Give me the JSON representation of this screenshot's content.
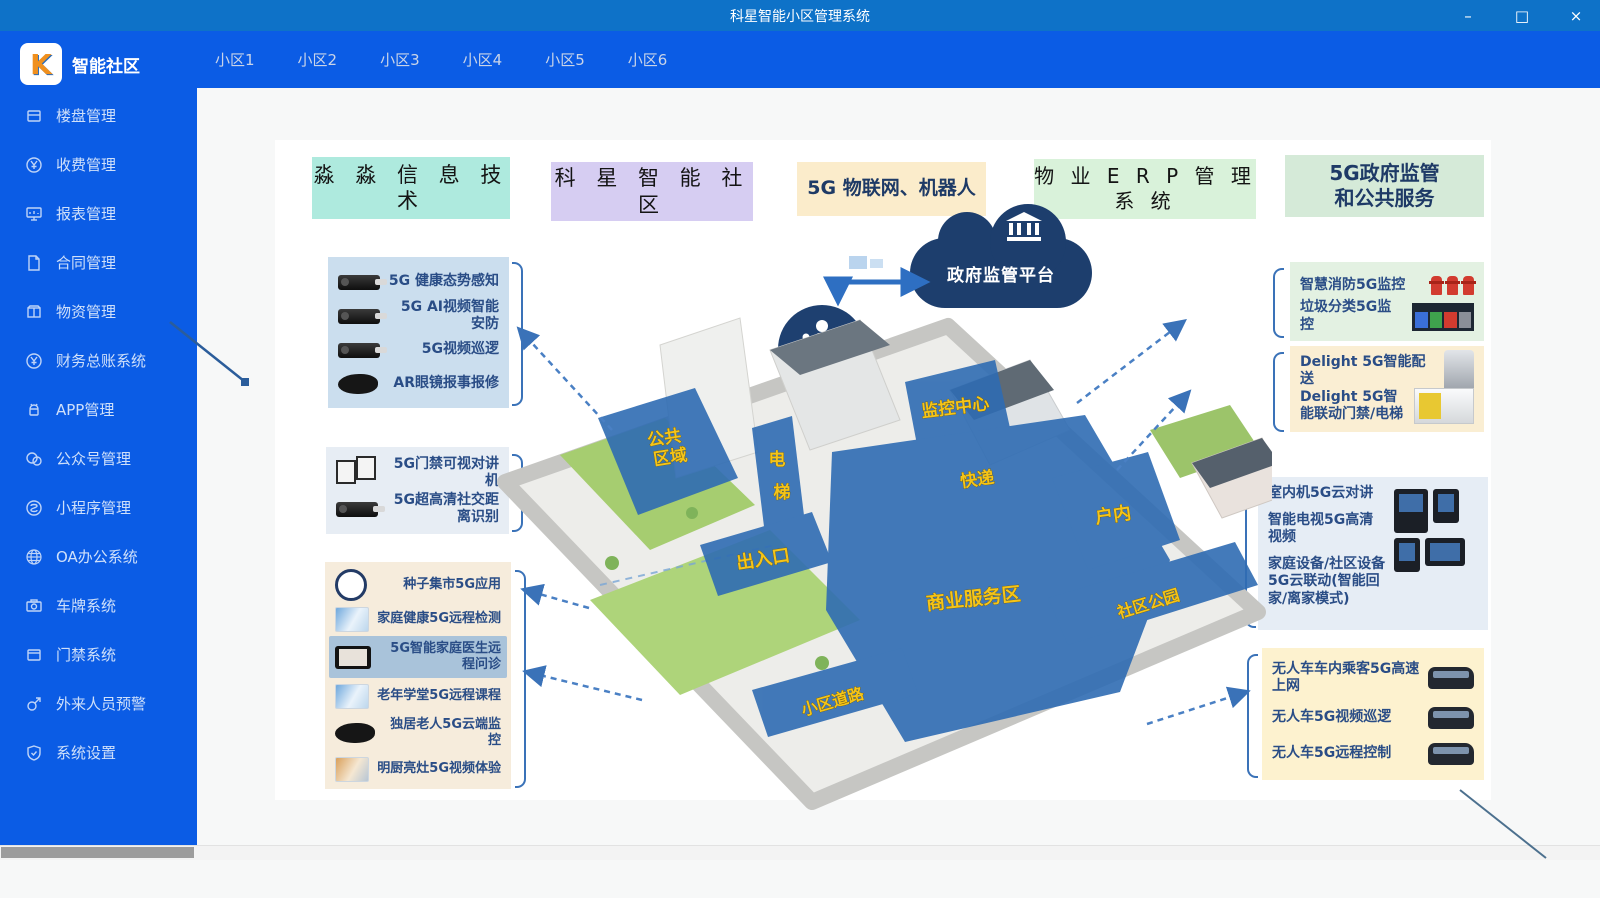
{
  "window": {
    "title": "科星智能小区管理系统",
    "controls": {
      "minimize": "–",
      "maximize": "□",
      "close": "×"
    }
  },
  "brand": {
    "logo_letter": "K",
    "name": "智能社区"
  },
  "tabs": [
    {
      "label": "小区1"
    },
    {
      "label": "小区2"
    },
    {
      "label": "小区3"
    },
    {
      "label": "小区4"
    },
    {
      "label": "小区5"
    },
    {
      "label": "小区6"
    }
  ],
  "sidebar": {
    "items": [
      {
        "icon": "building-icon",
        "label": "楼盘管理"
      },
      {
        "icon": "fee-yen-icon",
        "label": "收费管理"
      },
      {
        "icon": "report-icon",
        "label": "报表管理"
      },
      {
        "icon": "contract-icon",
        "label": "合同管理"
      },
      {
        "icon": "materials-icon",
        "label": "物资管理"
      },
      {
        "icon": "ledger-yen-icon",
        "label": "财务总账系统"
      },
      {
        "icon": "app-android-icon",
        "label": "APP管理"
      },
      {
        "icon": "wechat-icon",
        "label": "公众号管理"
      },
      {
        "icon": "miniprogram-icon",
        "label": "小程序管理"
      },
      {
        "icon": "oa-globe-icon",
        "label": "OA办公系统"
      },
      {
        "icon": "plate-camera-icon",
        "label": "车牌系统"
      },
      {
        "icon": "door-icon",
        "label": "门禁系统"
      },
      {
        "icon": "visitor-male-icon",
        "label": "外来人员预警"
      },
      {
        "icon": "settings-shield-icon",
        "label": "系统设置"
      }
    ]
  },
  "diagram": {
    "headers": [
      {
        "text": "淼 淼 信 息 技 术"
      },
      {
        "text": "科 星 智 能 社 区"
      },
      {
        "text": "5G 物联网、机器人"
      },
      {
        "line1": "物 业 E R P 管 理",
        "line2": "系 统"
      },
      {
        "line1": "5G政府监管",
        "line2": "和公共服务"
      }
    ],
    "left_boxes": [
      {
        "rows": [
          {
            "icon": "camera-image",
            "text": "5G 健康态势感知"
          },
          {
            "icon": "camera-image",
            "text": "5G AI视频智能安防"
          },
          {
            "icon": "camera-image",
            "text": "5G视频巡逻"
          },
          {
            "icon": "ar-glasses-image",
            "text": "AR眼镜报事报修"
          }
        ]
      },
      {
        "rows": [
          {
            "icon": "turnstile-image",
            "text": "5G门禁可视对讲机"
          },
          {
            "icon": "camera-image",
            "text": "5G超高清社交距离识别"
          }
        ]
      },
      {
        "rows": [
          {
            "icon": "round-badge-image",
            "text": "种子集市5G应用"
          },
          {
            "icon": "screenshot-image",
            "text": "家庭健康5G远程检测"
          },
          {
            "icon": "tablet-image",
            "text": "5G智能家庭医生远程问诊"
          },
          {
            "icon": "screenshot-image",
            "text": "老年学堂5G远程课程"
          },
          {
            "icon": "ar-glasses-image",
            "text": "独居老人5G云端监控"
          },
          {
            "icon": "storefront-image",
            "text": "明厨亮灶5G视频体验"
          }
        ]
      }
    ],
    "right_boxes": [
      {
        "rows": [
          {
            "text": "智慧消防5G监控",
            "icon": "fire-hydrant-image"
          },
          {
            "text": "垃圾分类5G监控",
            "icon": "trash-bins-image"
          }
        ]
      },
      {
        "rows": [
          {
            "text": "Delight 5G智能配送",
            "icon": "delivery-robot-image"
          },
          {
            "text": "Delight 5G智能联动门禁/电梯",
            "icon": "gate-machine-image"
          }
        ]
      },
      {
        "lines": [
          "室内机5G云对讲",
          "智能电视5G高清视频",
          "家庭设备/社区设备5G云联动(智能回家/离家模式)"
        ],
        "icon": "intercom-devices-image"
      },
      {
        "rows": [
          {
            "text": "无人车车内乘客5G高速上网",
            "icon": "shuttle-image"
          },
          {
            "text": "无人车5G视频巡逻",
            "icon": "shuttle-image"
          },
          {
            "text": "无人车5G远程控制",
            "icon": "shuttle-image"
          }
        ]
      }
    ],
    "cloud": {
      "label": "政府监管平台",
      "icon": "government-building-icon"
    },
    "brain": {
      "label": "社区大脑",
      "icon": "community-people-icon"
    },
    "map": {
      "labels": [
        {
          "text": "公共区域",
          "line1": "公共",
          "line2": "区域"
        },
        {
          "text": "电梯",
          "line1": "电",
          "line2": "梯"
        },
        {
          "text": "出入口"
        },
        {
          "text": "监控中心"
        },
        {
          "text": "快递"
        },
        {
          "text": "商业服务区"
        },
        {
          "text": "户内"
        },
        {
          "text": "社区公园"
        },
        {
          "text": "小区道路"
        }
      ]
    }
  },
  "colors": {
    "titlebar": "#0e72c8",
    "sidebar": "#0b5ce5",
    "navy_accent": "#1d3e6d",
    "callout_text": "#2a4d86",
    "overlay_blue": "#2f6cb3",
    "map_label_yellow": "#f4c41a",
    "header_bgs": [
      "#aeeade",
      "#d6cdf2",
      "#fbeccb",
      "#d9f2da",
      "#d5ead8"
    ]
  }
}
